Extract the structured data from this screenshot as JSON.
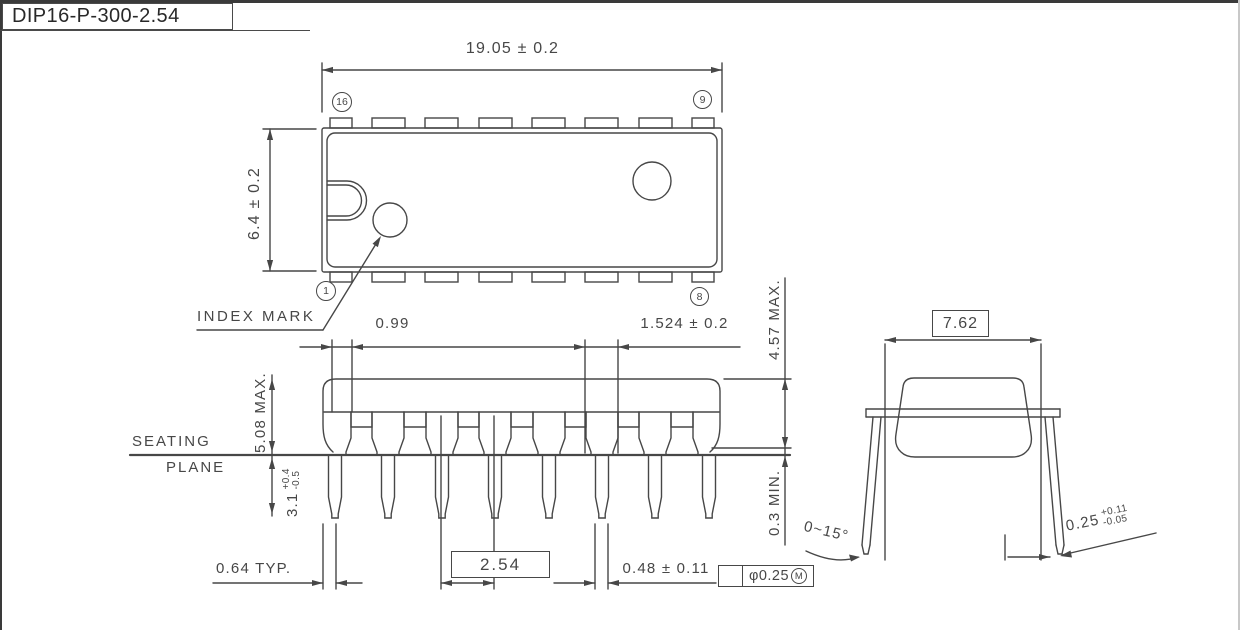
{
  "title": "DIP16-P-300-2.54",
  "top_view": {
    "dim_length": "19.05 ± 0.2",
    "dim_width": "6.4 ± 0.2",
    "pin_16": "16",
    "pin_9": "9",
    "pin_1": "1",
    "pin_8": "8",
    "index_mark_label": "INDEX MARK"
  },
  "front_view": {
    "dim_lead_offset": "0.99",
    "dim_shoulder_width": "1.524 ± 0.2",
    "dim_body_height": "4.57 MAX.",
    "dim_seated_height": "5.08 MAX.",
    "seating_plane_line1": "SEATING",
    "seating_plane_line2": "PLANE",
    "dim_lead_length": "3.1",
    "dim_lead_length_tol_plus": "+0.4",
    "dim_lead_length_tol_minus": "-0.5",
    "dim_standoff": "0.3 MIN.",
    "dim_lead_tip_width": "0.64 TYP.",
    "dim_pitch": "2.54",
    "dim_lead_width": "0.48 ± 0.11",
    "tolerance_frame": {
      "diameter": "φ0.25",
      "modifier": "M"
    }
  },
  "end_view": {
    "dim_row_spacing": "7.62",
    "dim_lead_angle": "0~15°",
    "dim_lead_thickness": "0.25",
    "dim_lead_thickness_tol_plus": "+0.11",
    "dim_lead_thickness_tol_minus": "-0.05"
  },
  "colors": {
    "line": "#474747",
    "text": "#474747",
    "frame_dark": "#3a3a3a",
    "frame_light": "#c8c8c8"
  }
}
